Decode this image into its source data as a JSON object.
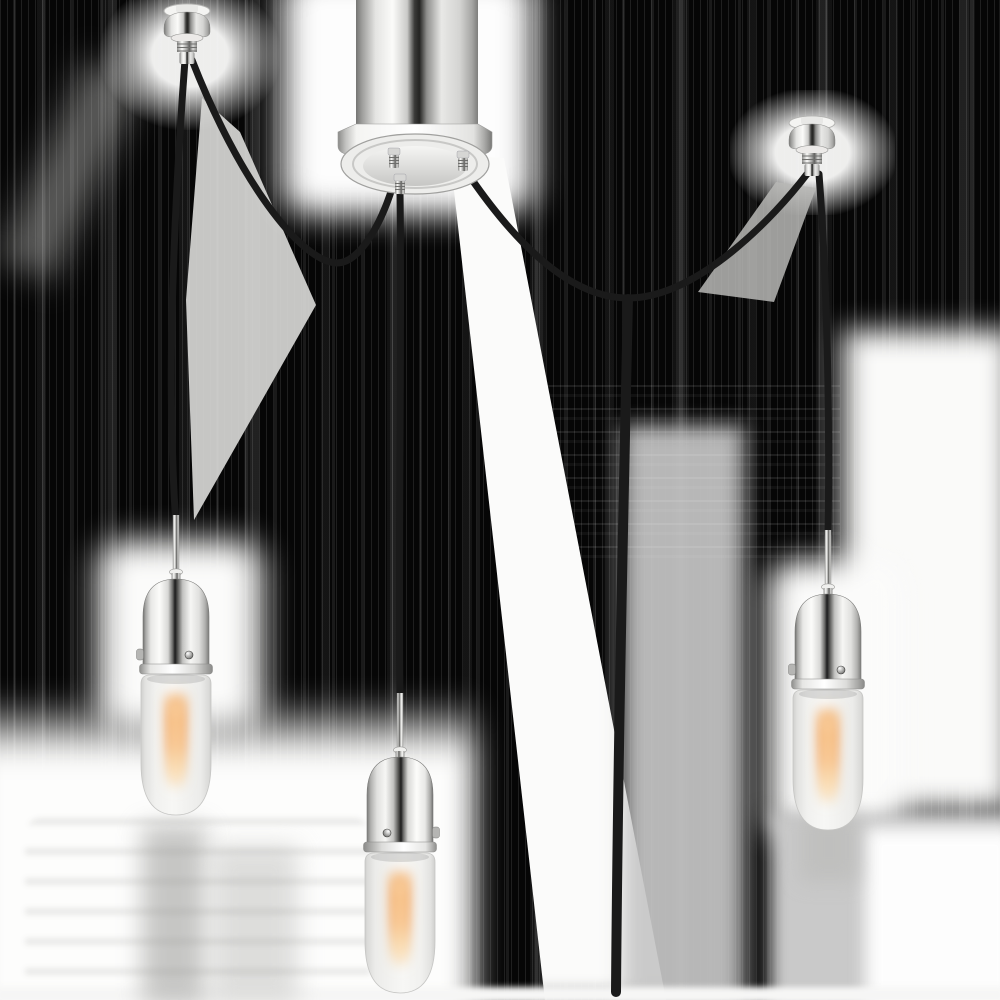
{
  "meta": {
    "title": "Three-light swag pendant chandelier product photo",
    "description": "Product image of a plug-in swag chandelier: a central polished nickel ceiling canopy with three black fabric cords, two nickel swag anchor fittings, and three pendant lights with polished nickel dome sockets holding lit frosted capsule bulbs. Background is transparent rendered as black with white halo remnants and banding artifacts.",
    "text_content": "none"
  },
  "colors": {
    "background_base": "#060606",
    "halo_white": "#fdfdfc",
    "halo_gray": "#c6c6c6",
    "cord": "#1a1a1a",
    "nickel_highlight": "#ffffff",
    "nickel_mid": "#d8d8d6",
    "nickel_dark_core": "#1c1c1c",
    "bulb_glass": "#f3f3f1",
    "glow_core": "#f2a55e",
    "glow_soft": "#ffe9c4"
  },
  "background": {
    "style": "black transparency fill with vertical gray banding artifacts",
    "highlight_regions": [
      "canopy-halo",
      "wedge-below-canopy",
      "gray-column-bottom-center",
      "lower-left-white-field",
      "left-pendant-halo",
      "left-anchor-halo",
      "between-cords-gray-wedge-left",
      "right-anchor-halo",
      "right-anchor-gray-wedge",
      "right-white-field",
      "right-pendant-halo",
      "bottom-right-gray",
      "bottom-white-strip"
    ]
  },
  "fixture": {
    "type": "swag-pendant-chandelier",
    "light_count": 3,
    "finish": "polished-nickel",
    "cord_finish": "black-fabric",
    "bulb_style": "frosted-capsule-tube",
    "bulbs_lit": true,
    "canopy": {
      "part": "ceiling-canopy",
      "shape": "cylinder-with-flanged-round-plate",
      "cord_grips": 3
    },
    "anchors": [
      {
        "part": "swag-anchor-left",
        "position": "top-left"
      },
      {
        "part": "swag-anchor-right",
        "position": "upper-right"
      }
    ],
    "cords": [
      {
        "part": "left-drop-cord",
        "from": "left-anchor",
        "to": "left-pendant"
      },
      {
        "part": "left-swag-cord",
        "from": "left-anchor",
        "to": "canopy",
        "draped": true
      },
      {
        "part": "center-drop-cord",
        "from": "canopy",
        "to": "center-pendant"
      },
      {
        "part": "right-swag-cord",
        "from": "canopy",
        "to": "right-anchor",
        "draped": true
      },
      {
        "part": "right-drop-cord",
        "from": "right-anchor",
        "to": "right-pendant"
      },
      {
        "part": "power-cord",
        "from": "right-swag-low-point",
        "to": "bottom-edge"
      }
    ],
    "pendants": [
      {
        "part": "pendant-left",
        "socket": "nickel-dome-socket",
        "bulb": "frosted-capsule",
        "lit": true
      },
      {
        "part": "pendant-center",
        "socket": "nickel-dome-socket",
        "bulb": "frosted-capsule",
        "lit": true
      },
      {
        "part": "pendant-right",
        "socket": "nickel-dome-socket",
        "bulb": "frosted-capsule",
        "lit": true
      }
    ]
  }
}
